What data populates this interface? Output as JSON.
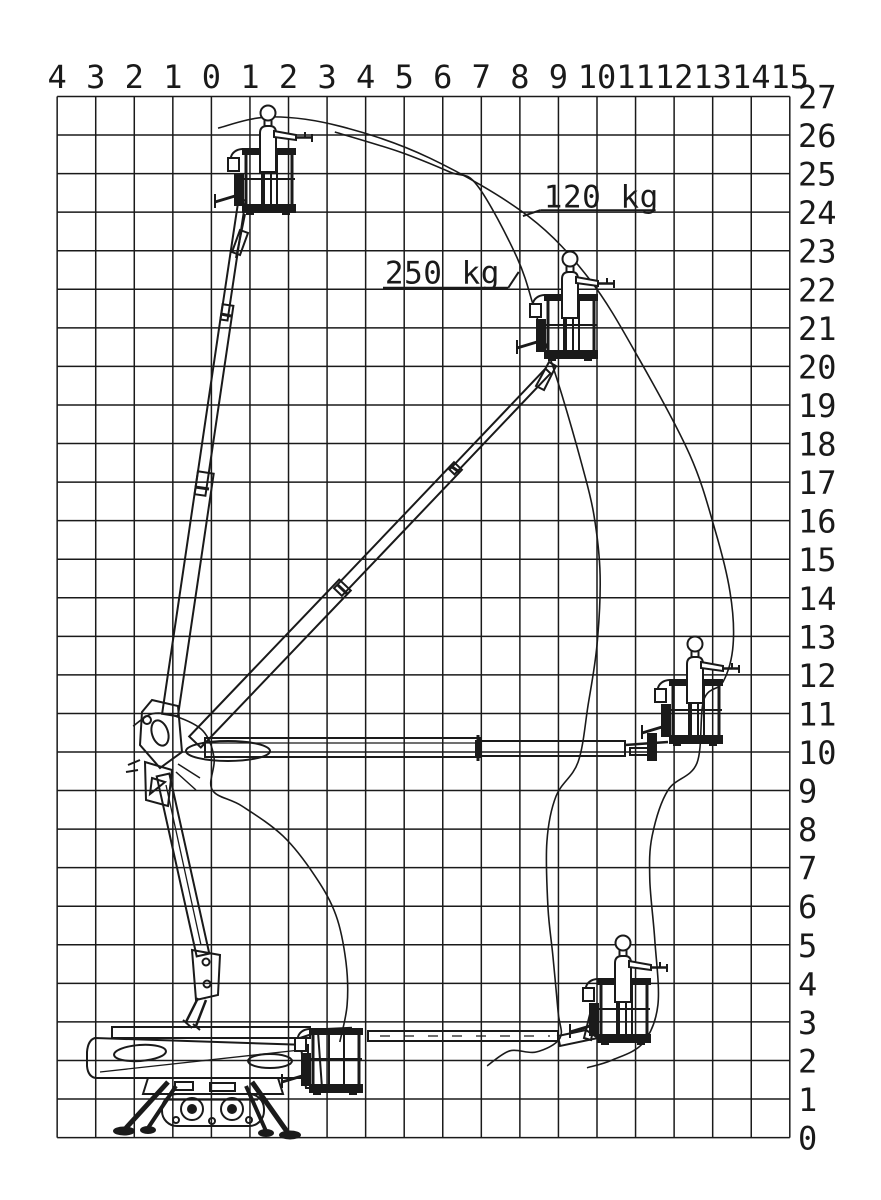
{
  "page": {
    "background": "#ffffff",
    "line_color": "#1a1a1a"
  },
  "chart_data": {
    "type": "line",
    "title": "Aerial work platform working envelope diagram",
    "grid": true,
    "x_axis": {
      "unit": "m",
      "m_min": -4,
      "m_max": 15,
      "labels": [
        "4",
        "3",
        "2",
        "1",
        "0",
        "1",
        "2",
        "3",
        "4",
        "5",
        "6",
        "7",
        "8",
        "9",
        "10",
        "11",
        "12",
        "13",
        "14",
        "15"
      ]
    },
    "y_axis": {
      "unit": "m",
      "m_min": 0,
      "m_max": 27,
      "labels_top_to_bottom": [
        "27",
        "26",
        "25",
        "24",
        "23",
        "22",
        "21",
        "20",
        "19",
        "18",
        "17",
        "16",
        "15",
        "14",
        "13",
        "12",
        "11",
        "10",
        "9",
        "8",
        "7",
        "6",
        "5",
        "4",
        "3",
        "2",
        "1",
        "0"
      ]
    },
    "series": [
      {
        "name": "120 kg envelope",
        "points_m": [
          [
            0.17,
            26.18
          ],
          [
            1.52,
            26.47
          ],
          [
            3.33,
            26.23
          ],
          [
            5.67,
            25.4
          ],
          [
            8.21,
            23.9
          ],
          [
            9.82,
            22.24
          ],
          [
            11.11,
            20.16
          ],
          [
            12.41,
            17.7
          ],
          [
            13.06,
            15.76
          ],
          [
            13.45,
            14.15
          ],
          [
            13.53,
            12.78
          ],
          [
            13.27,
            11.82
          ],
          [
            12.77,
            11.35
          ],
          [
            12.59,
            9.71
          ],
          [
            11.84,
            9.01
          ],
          [
            11.43,
            7.82
          ],
          [
            11.37,
            6.68
          ],
          [
            11.5,
            5.12
          ],
          [
            11.58,
            3.44
          ],
          [
            11.19,
            2.45
          ],
          [
            10.39,
            2.01
          ],
          [
            9.74,
            1.81
          ]
        ]
      },
      {
        "name": "250 kg envelope",
        "points_m": [
          [
            3.2,
            26.08
          ],
          [
            4.89,
            25.56
          ],
          [
            6.19,
            25.04
          ],
          [
            6.89,
            24.7
          ],
          [
            7.93,
            22.81
          ],
          [
            8.44,
            21.28
          ],
          [
            9.09,
            19.26
          ],
          [
            9.61,
            17.44
          ],
          [
            9.92,
            16.15
          ],
          [
            10.08,
            14.59
          ],
          [
            10.0,
            12.78
          ],
          [
            9.77,
            11.22
          ],
          [
            9.51,
            9.74
          ],
          [
            8.94,
            8.86
          ],
          [
            8.7,
            7.67
          ],
          [
            8.73,
            5.95
          ],
          [
            8.86,
            4.68
          ],
          [
            8.99,
            3.26
          ],
          [
            9.04,
            2.58
          ],
          [
            8.42,
            2.22
          ],
          [
            7.74,
            2.25
          ],
          [
            7.15,
            1.86
          ]
        ]
      },
      {
        "name": "inner boundary near base",
        "points_m": [
          [
            -2.03,
            10.67
          ],
          [
            -1.54,
            10.99
          ],
          [
            -0.94,
            10.93
          ],
          [
            -0.22,
            10.55
          ],
          [
            0.07,
            9.84
          ],
          [
            0.02,
            9.02
          ],
          [
            0.79,
            8.6
          ],
          [
            1.86,
            7.82
          ],
          [
            2.69,
            6.78
          ],
          [
            3.23,
            5.77
          ],
          [
            3.49,
            4.55
          ],
          [
            3.52,
            3.44
          ],
          [
            3.33,
            2.48
          ]
        ]
      }
    ],
    "annotations": [
      {
        "id": "label-120kg",
        "text": "120 kg",
        "text_pos_m": [
          8.62,
          24.12
        ],
        "underline_m": [
          [
            8.53,
            24.05
          ],
          [
            11.52,
            24.05
          ]
        ],
        "leader_m": [
          [
            8.53,
            24.05
          ],
          [
            8.08,
            23.9
          ]
        ]
      },
      {
        "id": "label-250kg",
        "text": "250 kg",
        "text_pos_m": [
          4.5,
          22.15
        ],
        "underline_m": [
          [
            4.45,
            22.04
          ],
          [
            7.7,
            22.04
          ]
        ],
        "leader_m": [
          [
            7.7,
            22.04
          ],
          [
            7.97,
            22.45
          ]
        ]
      }
    ]
  }
}
